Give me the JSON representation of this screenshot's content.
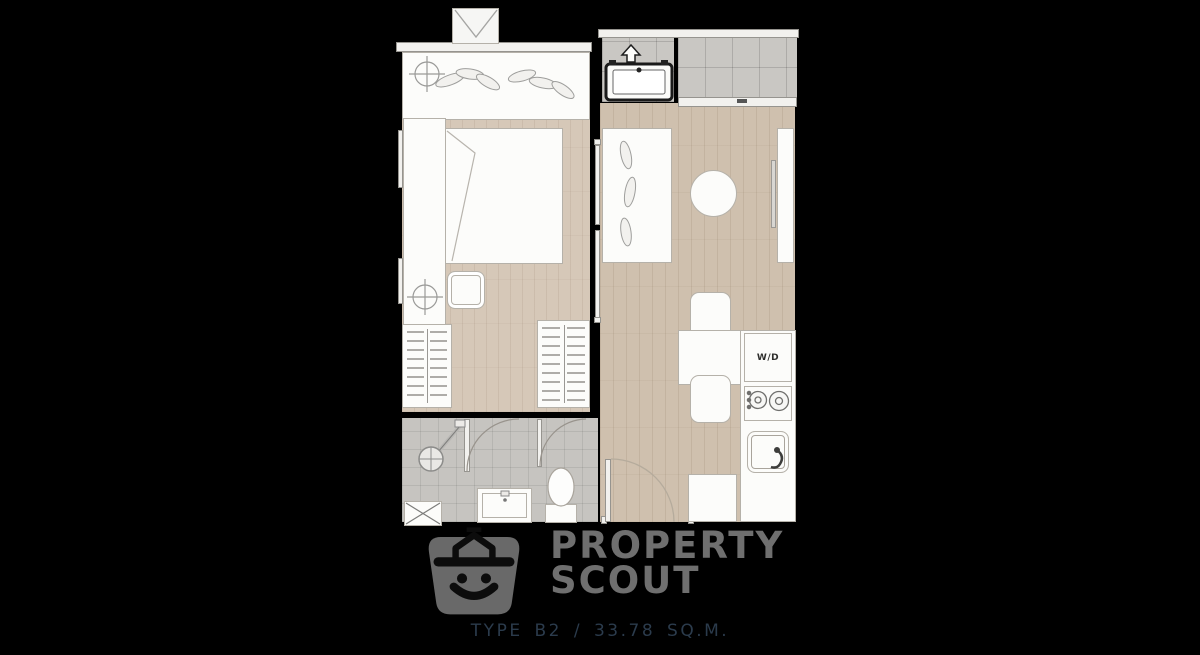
{
  "page": {
    "background": "#000000"
  },
  "floorplan": {
    "labels": {
      "washer_dryer": "W/D"
    },
    "symbols": [
      "bed",
      "wall-shelf",
      "wardrobe",
      "bedside-table",
      "sliding-partition",
      "console-desk",
      "round-table",
      "tv-console",
      "dining-table",
      "dining-chair",
      "washer-dryer",
      "stove",
      "kitchen-sink",
      "refrigerator",
      "shower",
      "vanity-sink",
      "toilet",
      "balcony",
      "ac-unit",
      "entry-door",
      "shaft"
    ],
    "colors": {
      "wood_floor": "#cfc0ae",
      "bedroom_floor": "#d6c8b8",
      "tile_floor": "#c9c7c3",
      "bath_tile": "#c6c4c0",
      "furniture": "#fcfcfa",
      "outline": "#b5b1a9",
      "wall": "#000000"
    }
  },
  "watermark": {
    "brand_top": "PROPERTY",
    "brand_bottom": "SCOUT",
    "logo_color": "#696969",
    "brand_color": "#6f6f6f"
  },
  "caption": {
    "text": "TYPE B2 / 33.78 SQ.M.",
    "caption_color": "#2b3b4c"
  }
}
